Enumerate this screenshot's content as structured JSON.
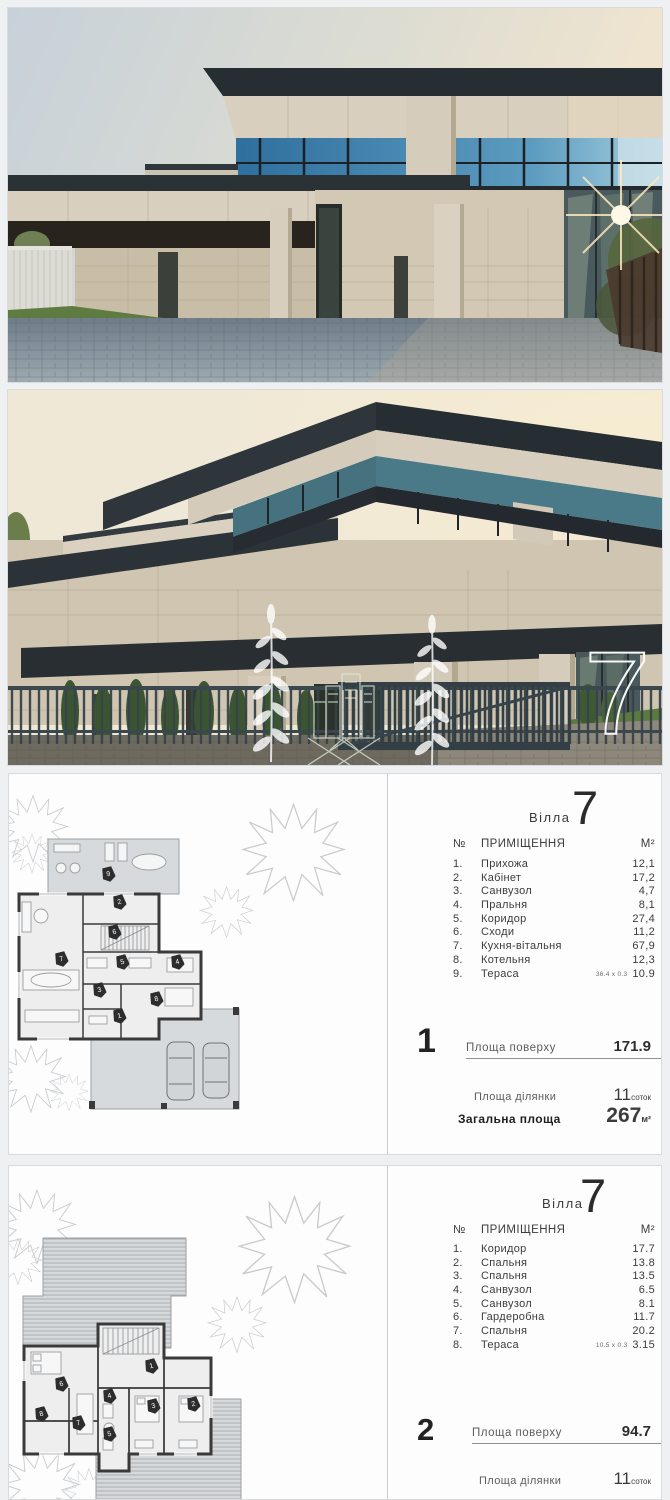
{
  "photo2": {
    "overlay_number": "7"
  },
  "plan1": {
    "villa_label": "Вілла",
    "villa_number": "7",
    "header": {
      "no": "№",
      "room": "ПРИМІЩЕННЯ",
      "area": "М²"
    },
    "rows": [
      {
        "no": "1.",
        "name": "Прихожа",
        "area": "12,1"
      },
      {
        "no": "2.",
        "name": "Кабінет",
        "area": "17,2"
      },
      {
        "no": "3.",
        "name": "Санвузол",
        "area": "4,7"
      },
      {
        "no": "4.",
        "name": "Пральня",
        "area": "8,1"
      },
      {
        "no": "5.",
        "name": "Коридор",
        "area": "27,4"
      },
      {
        "no": "6.",
        "name": "Сходи",
        "area": "11,2"
      },
      {
        "no": "7.",
        "name": "Кухня-вітальня",
        "area": "67,9"
      },
      {
        "no": "8.",
        "name": "Котельня",
        "area": "12,3"
      },
      {
        "no": "9.",
        "name": "Тераса",
        "note": "36.4 х 0.3",
        "area": "10.9"
      }
    ],
    "floor_number": "1",
    "floor_area_label": "Площа поверху",
    "floor_area_value": "171.9",
    "plot_label": "Площа ділянки",
    "plot_value": "11",
    "plot_unit": "соток",
    "total_label": "Загальна площа",
    "total_value": "267",
    "total_unit": "м²",
    "markers": [
      "9",
      "2",
      "6",
      "7",
      "5",
      "4",
      "3",
      "8",
      "1"
    ]
  },
  "plan2": {
    "villa_label": "Вілла",
    "villa_number": "7",
    "header": {
      "no": "№",
      "room": "ПРИМІЩЕННЯ",
      "area": "М²"
    },
    "rows": [
      {
        "no": "1.",
        "name": "Коридор",
        "area": "17.7"
      },
      {
        "no": "2.",
        "name": "Спальня",
        "area": "13.8"
      },
      {
        "no": "3.",
        "name": "Спальня",
        "area": "13.5"
      },
      {
        "no": "4.",
        "name": "Санвузол",
        "area": "6.5"
      },
      {
        "no": "5.",
        "name": "Санвузол",
        "area": "8.1"
      },
      {
        "no": "6.",
        "name": "Гардеробна",
        "area": "11.7"
      },
      {
        "no": "7.",
        "name": "Спальня",
        "area": "20.2"
      },
      {
        "no": "8.",
        "name": "Тераса",
        "note": "10.5 х 0.3",
        "area": "3.15"
      }
    ],
    "floor_number": "2",
    "floor_area_label": "Площа поверху",
    "floor_area_value": "94.7",
    "plot_label": "Площа ділянки",
    "plot_value": "11",
    "plot_unit": "соток",
    "markers": [
      "1",
      "6",
      "4",
      "3",
      "2",
      "8",
      "7",
      "5"
    ]
  }
}
